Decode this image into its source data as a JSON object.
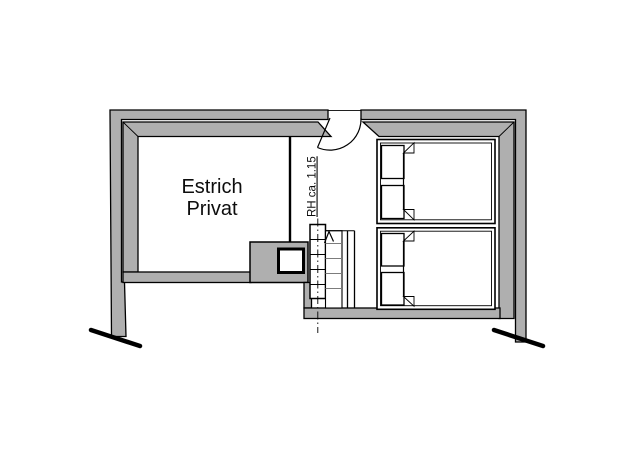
{
  "plan": {
    "room_label_line1": "Estrich",
    "room_label_line2": "Privat",
    "stair_annotation": "RH ca. 1.15"
  },
  "colors": {
    "background": "#ffffff",
    "wall_fill": "#afafaf",
    "line": "#000000",
    "minor_line": "#7c7c7c"
  },
  "symbols": [
    "door-swing",
    "winder-staircase",
    "stair-direction-arrow",
    "chimney-with-flue",
    "double-bed-top",
    "double-bed-bottom",
    "wall-break-line-left",
    "wall-break-line-right"
  ]
}
